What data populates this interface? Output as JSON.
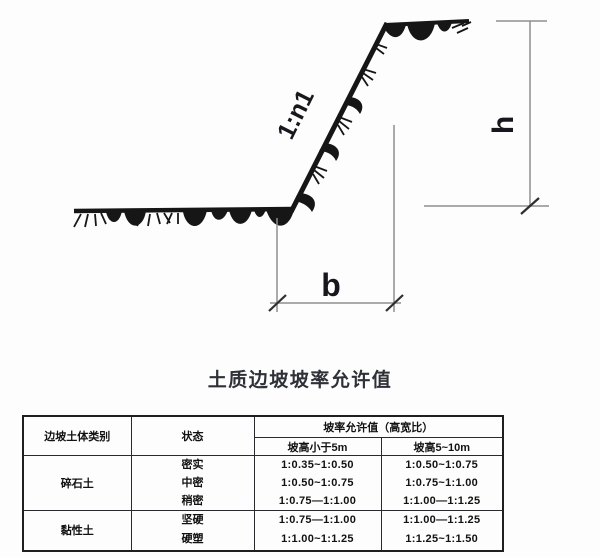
{
  "diagram": {
    "slope_ratio_label": "1:n1",
    "height_label": "h",
    "width_label": "b"
  },
  "table": {
    "title": "土质边坡坡率允许值",
    "headers": {
      "category": "边坡土体类别",
      "state": "状态",
      "ratio_group": "坡率允许值（高宽比）",
      "sub_lt5": "坡高小于5m",
      "sub_5_10": "坡高5~10m"
    },
    "blocks": [
      {
        "category": "碎石土",
        "rows": [
          {
            "state": "密实",
            "lt5": "1:0.35~1:0.50",
            "h510": "1:0.50~1:0.75"
          },
          {
            "state": "中密",
            "lt5": "1:0.50~1:0.75",
            "h510": "1:0.75~1:1.00"
          },
          {
            "state": "稍密",
            "lt5": "1:0.75—1:1.00",
            "h510": "1:1.00—1:1.25"
          }
        ]
      },
      {
        "category": "黏性土",
        "rows": [
          {
            "state": "坚硬",
            "lt5": "1:0.75—1:1.00",
            "h510": "1:1.00—1:1.25"
          },
          {
            "state": "硬塑",
            "lt5": "1:1.00~1:1.25",
            "h510": "1:1.25~1:1.50"
          }
        ]
      }
    ]
  }
}
